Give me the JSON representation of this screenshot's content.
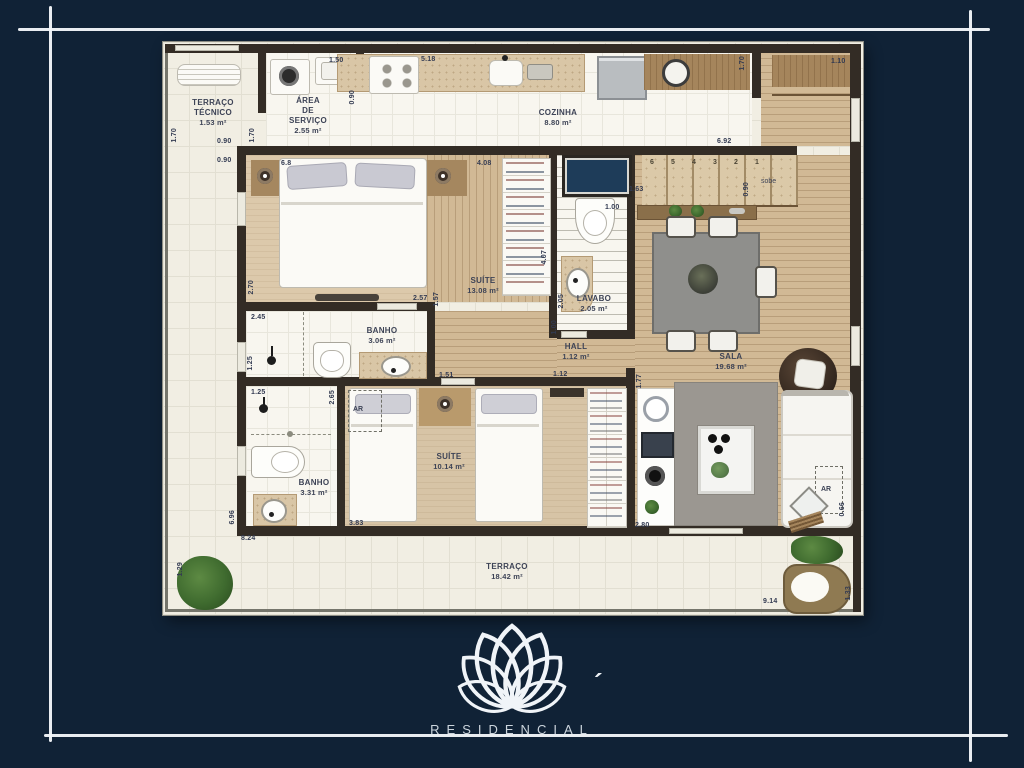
{
  "page": {
    "background": "#102236",
    "frame_color": "#f3f6f9"
  },
  "logo": {
    "brand_text": "RESIDENCIAL",
    "accent_mark": "´",
    "symbol": "lotus-flower-outline"
  },
  "rooms": {
    "terraco_tecnico": {
      "name": "TERRAÇO\nTÉCNICO",
      "area": "1.53 m²"
    },
    "area_servico": {
      "name": "ÁREA\nDE\nSERVIÇO",
      "area": "2.55 m²"
    },
    "cozinha": {
      "name": "COZINHA",
      "area": "8.80 m²"
    },
    "suite1": {
      "name": "SUÍTE",
      "area": "13.08 m²"
    },
    "lavabo": {
      "name": "LAVABO",
      "area": "2.05 m²"
    },
    "banho1": {
      "name": "BANHO",
      "area": "3.06 m²"
    },
    "banho2": {
      "name": "BANHO",
      "area": "3.31 m²"
    },
    "suite2": {
      "name": "SUÍTE",
      "area": "10.14 m²"
    },
    "hall": {
      "name": "HALL",
      "area": "1.12 m²"
    },
    "sala": {
      "name": "SALA",
      "area": "19.68 m²"
    },
    "terraco": {
      "name": "TERRAÇO",
      "area": "18.42 m²"
    }
  },
  "stairs": {
    "numbers": [
      "6",
      "5",
      "4",
      "3",
      "2",
      "1"
    ],
    "direction_label": "sobe"
  },
  "ac_labels": {
    "suite2": "AR",
    "sala": "AR"
  },
  "dims": [
    {
      "t": "1.50"
    },
    {
      "t": "5.18"
    },
    {
      "t": "0.90"
    },
    {
      "t": "1.10"
    },
    {
      "t": "1.70"
    },
    {
      "t": "6.92"
    },
    {
      "t": "1.70"
    },
    {
      "t": "0.90"
    },
    {
      "t": "0.90"
    },
    {
      "t": "1.70"
    },
    {
      "t": "4.08"
    },
    {
      "t": "6.8"
    },
    {
      "t": "2.70"
    },
    {
      "t": "2.57"
    },
    {
      "t": "1.57"
    },
    {
      "t": "2.45"
    },
    {
      "t": "1.25"
    },
    {
      "t": "1.25"
    },
    {
      "t": "2.65"
    },
    {
      "t": "4.07"
    },
    {
      "t": "1.00"
    },
    {
      "t": "2.05"
    },
    {
      "t": "1.00"
    },
    {
      "t": "1.63"
    },
    {
      "t": "0.90"
    },
    {
      "t": "1.51"
    },
    {
      "t": "1.12"
    },
    {
      "t": "1.77"
    },
    {
      "t": "3.83"
    },
    {
      "t": "2.80"
    },
    {
      "t": "6.96"
    },
    {
      "t": "8.24"
    },
    {
      "t": "1.29"
    },
    {
      "t": "0.66"
    },
    {
      "t": "9.14"
    },
    {
      "t": "1.33"
    }
  ],
  "colors": {
    "background_navy": "#102236",
    "frame_white": "#f3f6f9",
    "walls": "#332c25",
    "terrace_tile": "#f1eee3",
    "interior_tile": "#f8f6ef",
    "wood_floor": "#d1b995",
    "carpet": "#dcc9ab",
    "counter_marble": "#d9c6a6",
    "counter_wood": "#a5855c",
    "rug_gray": "#9b9791",
    "shaft_navy": "#1e3c59",
    "plant_green": "#3f6b2f",
    "label_text": "#3d4356"
  }
}
